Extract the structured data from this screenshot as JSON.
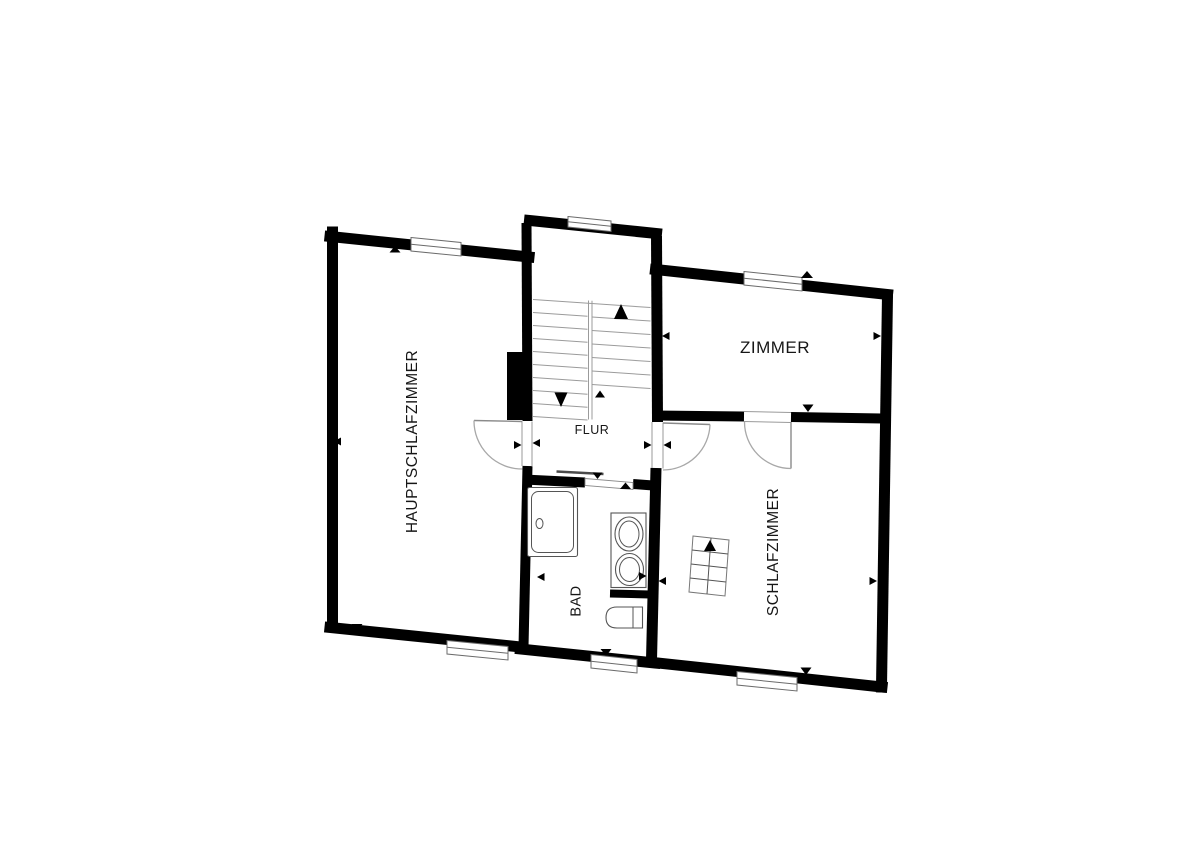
{
  "plan": {
    "type": "floor-plan",
    "rooms": [
      {
        "id": "hauptschlafzimmer",
        "label": "HAUPTSCHLAFZIMMER",
        "label_orientation": "vertical"
      },
      {
        "id": "zimmer",
        "label": "ZIMMER",
        "label_orientation": "horizontal"
      },
      {
        "id": "flur",
        "label": "FLUR",
        "label_orientation": "horizontal"
      },
      {
        "id": "bad",
        "label": "BAD",
        "label_orientation": "vertical"
      },
      {
        "id": "schlafzimmer",
        "label": "SCHLAFZIMMER",
        "label_orientation": "vertical"
      }
    ],
    "colors": {
      "background": "#ffffff",
      "wall": "#000000",
      "fixture_line": "#555555",
      "door_arc": "#a8a8a8",
      "stair_line": "#9b9b9b",
      "label_text": "#161616"
    }
  }
}
